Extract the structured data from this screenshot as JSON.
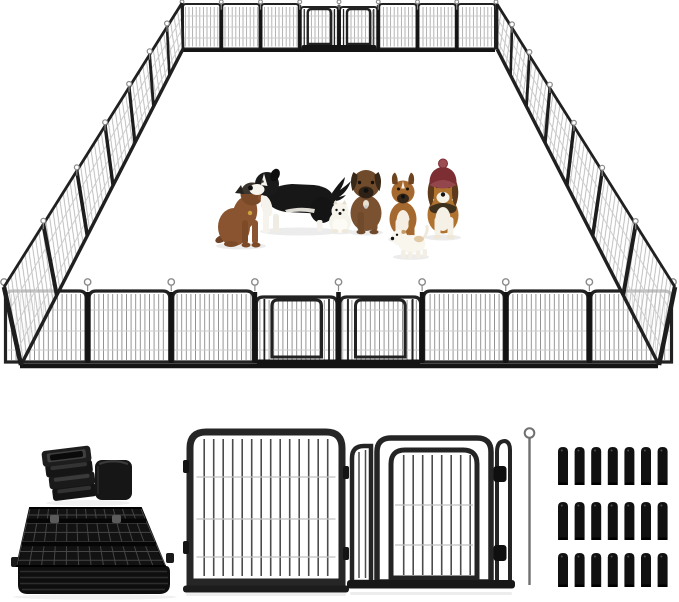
{
  "meta": {
    "title": "Heavy-duty metal dog playpen product image",
    "background": "#ffffff"
  },
  "colors": {
    "frame": "#222222",
    "frame_dark": "#141414",
    "mesh_bar_front": "#8a8a8a",
    "mesh_bar_back": "#9a9a9a",
    "mesh_bar_side": "#a6a6a6",
    "mesh_bar_detail": "#4b4b4b",
    "mesh_wire": "#cdcdcd",
    "panel_fill": "#ffffff",
    "pin": "#8a8a8a",
    "stake": "#111111",
    "rod": "#707070",
    "shadow": "#ececec",
    "hat_red": "#7c2e33",
    "toy_red": "#8c3034"
  },
  "pen": {
    "description": "Large rectangular exercise pen shown in perspective, assembled from black metal mesh panels with loop pins at every joint",
    "front_wall": {
      "panels": 8,
      "door_panel_indices": [
        3,
        4
      ],
      "pins": 9
    },
    "back_wall": {
      "panels": 8,
      "door_panel_indices": [
        3,
        4
      ],
      "pins": 9
    },
    "left_wall": {
      "panels": 7
    },
    "right_wall": {
      "panels": 7
    }
  },
  "dogs": [
    {
      "id": "brown-sitting-dog",
      "description": "Brown dog with dark crown and ears sitting, tongue out, facing right",
      "primary_color": "#8a5430"
    },
    {
      "id": "black-white-standing-dog",
      "description": "Large black and white dog standing in profile facing left with plumed tail raised",
      "primary_color": "#171717"
    },
    {
      "id": "white-pomeranian",
      "description": "Small fluffy cream puppy sitting",
      "primary_color": "#f7f4ec"
    },
    {
      "id": "brown-mastiff-puppy",
      "description": "Dark brown puppy with black muzzle and floppy ears sitting facing forward",
      "primary_color": "#7a5231"
    },
    {
      "id": "tan-boxer-puppy",
      "description": "Tan puppy with white chest and dark muzzle sitting facing forward",
      "primary_color": "#a5682e"
    },
    {
      "id": "white-terrier-puppy",
      "description": "Small white terrier puppy standing beside a red toy",
      "primary_color": "#f9f6ee"
    },
    {
      "id": "beagle-with-hat",
      "description": "Beagle wearing a dark red knit pom-pom hat, sitting facing forward",
      "primary_color": "#b0722f"
    }
  ],
  "accessories": {
    "rubber_feet": {
      "label": "anti-slip square foot caps",
      "stacked_caps": 4,
      "single_caps": 1
    },
    "folded_stack": {
      "label": "stack of folded fence panels"
    },
    "panel": {
      "label": "single fence panel, front view"
    },
    "door_panel": {
      "label": "door panel with hinge clamps, front view"
    },
    "rod": {
      "label": "connecting rod with loop top",
      "count": 1
    },
    "stakes": {
      "label": "ground anchor stakes",
      "rows": 3,
      "per_row": 7,
      "total": 21
    }
  }
}
